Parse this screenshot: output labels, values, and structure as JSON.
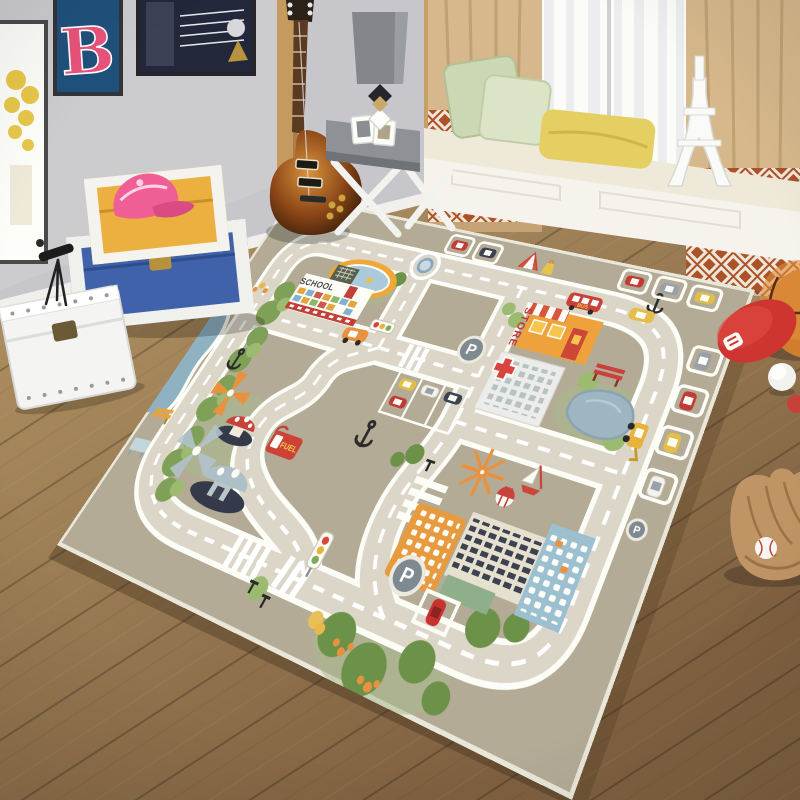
{
  "room": {
    "wall_color": "#c7c7cb",
    "floor_color": "#a08257",
    "curtain_color": "#d7b88c",
    "curtain_pattern_color": "#ab5226",
    "frames": {
      "letter_art": "B"
    }
  },
  "rug": {
    "field_color": "#b3ab96",
    "road_color": "#dbd6c8",
    "labels": {
      "school": "SCHOOL",
      "store": "STORE",
      "fuel": "FUEL",
      "bus": "BUS",
      "parking": "P"
    }
  }
}
